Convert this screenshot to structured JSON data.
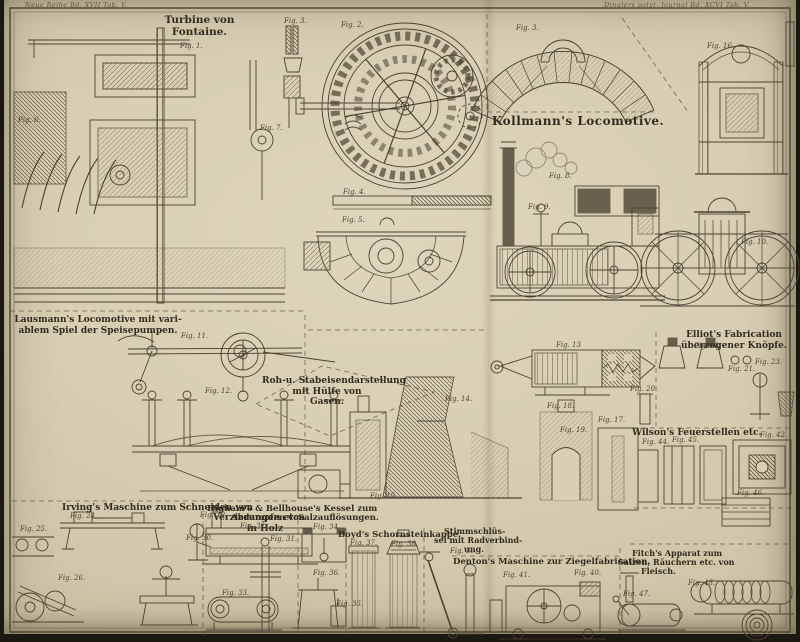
{
  "plate": {
    "marginalia_left": "Neue Reihe Bd. XVII Tab. V.",
    "marginalia_right": "Dinglers polyt. Journal Bd. XCVI Tab. V.",
    "colors": {
      "paper": "#d7ceb3",
      "ink": "#4a4331",
      "edge": "#1b1711"
    }
  },
  "sections": [
    {
      "id": "turbine",
      "lines": [
        "Turbine von",
        "Fontaine."
      ]
    },
    {
      "id": "kollmann",
      "lines": [
        "Kollmann's Locomotive."
      ]
    },
    {
      "id": "lausmann",
      "lines": [
        "Lausmann's Locomotive mit vari-",
        "ablem Spiel der Speisepumpen."
      ]
    },
    {
      "id": "roheisen",
      "lines": [
        "Roh-u. Stabeisendarstellung",
        "mit Hülfe von",
        "Gasen."
      ]
    },
    {
      "id": "elliot",
      "lines": [
        "Elliot's Fabrication",
        "überzogener Knöpfe."
      ]
    },
    {
      "id": "wilson",
      "lines": [
        "Wilson's Feuerstellen etc."
      ]
    },
    {
      "id": "irving",
      "lines": [
        "Irving's Maschine zum Schneiden von",
        "Verzierungen etc.",
        "in Holz"
      ]
    },
    {
      "id": "higham",
      "lines": [
        "Higham's & Bellhouse's Kessel zum",
        "Abdampfen von",
        "Salzauflösungen."
      ]
    },
    {
      "id": "boyd",
      "lines": [
        "Boyd's Schornsteinkappe."
      ]
    },
    {
      "id": "stimm",
      "lines": [
        "Stimmschlüs-",
        "sel mit Radverbind-",
        "ung."
      ]
    },
    {
      "id": "denton",
      "lines": [
        "Denton's Maschine zur Ziegelfabrication."
      ]
    },
    {
      "id": "fitch",
      "lines": [
        "Fitch's Apparat zum",
        "Salzen, Räuchern etc. von",
        "Fleisch."
      ]
    }
  ],
  "figure_labels": [
    {
      "label": "Fig. 1."
    },
    {
      "label": "Fig. 2."
    },
    {
      "label": "Fig. 3."
    },
    {
      "label": "Fig. 3."
    },
    {
      "label": "Fig. 4."
    },
    {
      "label": "Fig. 5."
    },
    {
      "label": "Fig. 6."
    },
    {
      "label": "Fig. 7."
    },
    {
      "label": "Fig. 8."
    },
    {
      "label": "Fig. 9."
    },
    {
      "label": "Fig. 10."
    },
    {
      "label": "Fig. 16."
    },
    {
      "label": "Fig. 11."
    },
    {
      "label": "Fig. 12."
    },
    {
      "label": "Fig. 13"
    },
    {
      "label": "Fig. 14."
    },
    {
      "label": "Fig. 18."
    },
    {
      "label": "Fig. 19."
    },
    {
      "label": "Fig. 17."
    },
    {
      "label": "Fig. 20."
    },
    {
      "label": "Fig. 15."
    },
    {
      "label": "Fig. 21."
    },
    {
      "label": "Fig. 23."
    },
    {
      "label": "Fig. 22."
    },
    {
      "label": "Fig. 42."
    },
    {
      "label": "Fig. 44."
    },
    {
      "label": "Fig. 45."
    },
    {
      "label": "Fig. 46."
    },
    {
      "label": "Fig. 24."
    },
    {
      "label": "Fig. 29."
    },
    {
      "label": "Fig. 30."
    },
    {
      "label": "Fig. 31."
    },
    {
      "label": "Fig. 25."
    },
    {
      "label": "Fig. 26."
    },
    {
      "label": "Fig. 32."
    },
    {
      "label": "Fig. 34."
    },
    {
      "label": "Fig. 33."
    },
    {
      "label": "Fig. 35."
    },
    {
      "label": "Fig. 36."
    },
    {
      "label": "Fig. 37."
    },
    {
      "label": "Fig. 38."
    },
    {
      "label": "Fig. 39."
    },
    {
      "label": "Fig. 41."
    },
    {
      "label": "Fig. 40."
    },
    {
      "label": "Fig. 48."
    },
    {
      "label": "Fig. 47."
    }
  ]
}
